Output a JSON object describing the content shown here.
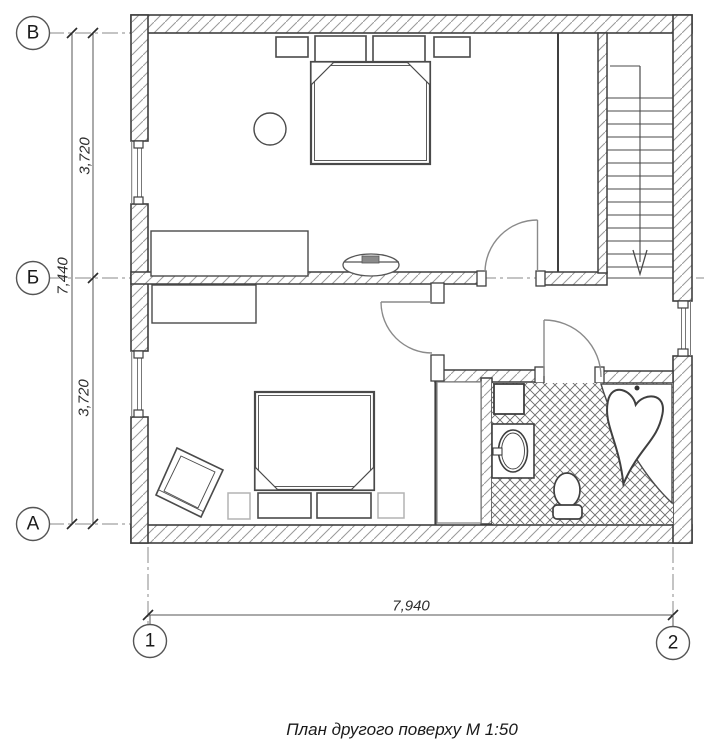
{
  "title": "План другого поверху М 1:50",
  "grid_axes": {
    "row_markers": [
      "В",
      "Б",
      "А"
    ],
    "column_markers": [
      "1",
      "2"
    ]
  },
  "dimensions": {
    "left_segment_top": "3,720",
    "left_total": "7,440",
    "left_segment_bottom": "3,720",
    "bottom_total": "7,940"
  },
  "colors": {
    "wall_line": "#3f3f3f",
    "wall_hatch": "#999999",
    "floor_hatch": "#666666",
    "door_arc": "#8a8a8a",
    "light_furniture": "#b3b3b3",
    "background": "#ffffff"
  }
}
